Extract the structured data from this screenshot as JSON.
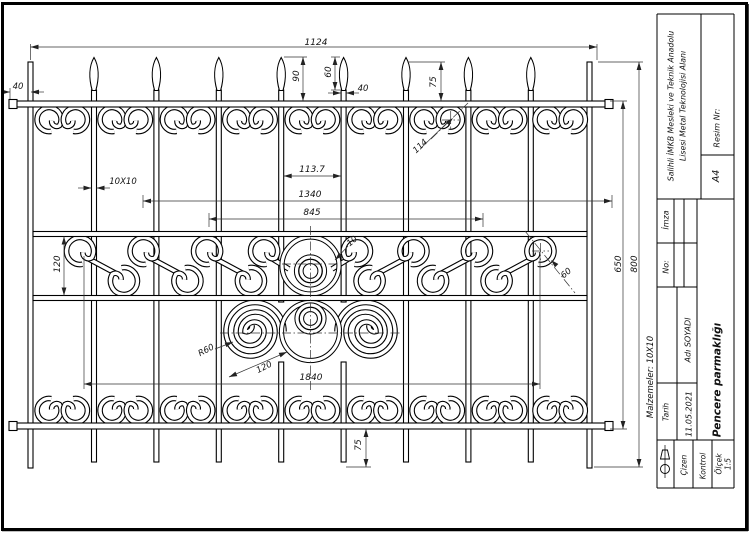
{
  "page": {
    "kind": "technical-drawing",
    "paper": "A4",
    "orientation": "landscape"
  },
  "title_block": {
    "school_line1": "Salihli İMKB Mesleki ve Teknik Anadolu",
    "school_line2": "Lisesi Metal Teknolojisi Alanı",
    "resim_label": "Resim Nr:",
    "paper_size": "A4",
    "imza_label": "İmza",
    "no_label": "No:",
    "author": "Adı SOYADI",
    "tarih_label": "Tarih",
    "tarih_value": "11.05.2021",
    "cizen_label": "Çizen",
    "kontrol_label": "Kontrol",
    "olcek_label": "Ölçek",
    "olcek_value": "1:5",
    "drawing_title": "Pencere parmaklığı",
    "materials_note": "Malzemeler: 10X10"
  },
  "tb_labels": [
    {
      "id": "school-1",
      "t": "Salihli İMKB Mesleki ve Teknik Anadolu",
      "x": 671,
      "y": 106,
      "rot": -90,
      "s": 7.8
    },
    {
      "id": "school-2",
      "t": "Lisesi Metal Teknolojisi Alanı",
      "x": 683,
      "y": 106,
      "rot": -90,
      "s": 7.8
    },
    {
      "id": "resim-nr",
      "t": "Resim Nr:",
      "x": 717,
      "y": 128,
      "rot": -90,
      "s": 8
    },
    {
      "id": "paper",
      "t": "A4",
      "x": 716,
      "y": 176,
      "rot": -90,
      "s": 9.5
    },
    {
      "id": "imza",
      "t": "İmza",
      "x": 666,
      "y": 220,
      "rot": -90,
      "s": 8
    },
    {
      "id": "no",
      "t": "No:",
      "x": 666,
      "y": 267,
      "rot": -90,
      "s": 8
    },
    {
      "id": "author",
      "t": "Adı SOYADI",
      "x": 688,
      "y": 340,
      "rot": -90,
      "s": 8
    },
    {
      "id": "tarih",
      "t": "Tarih",
      "x": 666,
      "y": 412,
      "rot": -90,
      "s": 7.5
    },
    {
      "id": "tarih-val",
      "t": "11.05.2021",
      "x": 689,
      "y": 414,
      "rot": -90,
      "s": 8
    },
    {
      "id": "cizen",
      "t": "Çizen",
      "x": 684,
      "y": 465,
      "rot": -90,
      "s": 7.5
    },
    {
      "id": "kontrol",
      "t": "Kontrol",
      "x": 703,
      "y": 466,
      "rot": -90,
      "s": 7.5
    },
    {
      "id": "olcek",
      "t": "Ölçek",
      "x": 719,
      "y": 464,
      "rot": -90,
      "s": 7.5
    },
    {
      "id": "olcek-val",
      "t": "1:5",
      "x": 728,
      "y": 464,
      "rot": -90,
      "s": 7.5
    },
    {
      "id": "drawing-title",
      "t": "Pencere parmaklığı",
      "x": 717,
      "y": 380,
      "rot": -90,
      "s": 10.5,
      "b": 1
    },
    {
      "id": "materials",
      "t": "Malzemeler: 10X10",
      "x": 650,
      "y": 377,
      "rot": -90,
      "s": 8.5
    }
  ],
  "dimensions": [
    {
      "t": "1124",
      "x": 316,
      "y": 42,
      "rot": 0,
      "lines": [
        [
          30.5,
          47,
          597,
          47
        ],
        [
          30.5,
          44,
          30.5,
          60
        ],
        [
          597,
          44,
          597,
          60
        ]
      ],
      "arr": [
        [
          30.5,
          47,
          180
        ],
        [
          597,
          47,
          0
        ]
      ]
    },
    {
      "t": "40",
      "x": 18,
      "y": 86,
      "rot": 0,
      "s": 8.5,
      "lines": [
        [
          2,
          92,
          10,
          92
        ],
        [
          31,
          92,
          44,
          92
        ],
        [
          10,
          88,
          10,
          99
        ]
      ],
      "arr": [
        [
          10,
          92,
          0
        ],
        [
          31,
          92,
          180
        ]
      ]
    },
    {
      "t": "90",
      "x": 296,
      "y": 76,
      "rot": -90,
      "lines": [
        [
          303,
          57,
          303,
          101
        ],
        [
          284,
          57,
          307,
          57
        ]
      ],
      "arr": [
        [
          303,
          57,
          -90
        ],
        [
          303,
          101,
          90
        ]
      ]
    },
    {
      "t": "60",
      "x": 328,
      "y": 72,
      "rot": -90,
      "lines": [
        [
          335,
          57,
          335,
          90
        ],
        [
          340,
          57,
          331,
          57
        ],
        [
          340,
          90,
          331,
          90
        ]
      ],
      "arr": [
        [
          335,
          57,
          -90
        ],
        [
          335,
          90,
          90
        ]
      ]
    },
    {
      "t": "40",
      "x": 363,
      "y": 88,
      "rot": 0,
      "s": 8.5,
      "lines": [
        [
          328,
          93,
          341,
          93
        ],
        [
          346,
          93,
          359,
          93
        ]
      ],
      "arr": [
        [
          341,
          93,
          0
        ],
        [
          346,
          93,
          180
        ]
      ]
    },
    {
      "t": "75",
      "x": 433,
      "y": 82,
      "rot": -90,
      "lines": [
        [
          441,
          62,
          441,
          101
        ],
        [
          408,
          62,
          445,
          62
        ]
      ],
      "arr": [
        [
          441,
          62,
          -90
        ],
        [
          441,
          101,
          90
        ]
      ]
    },
    {
      "t": "114",
      "x": 420,
      "y": 146,
      "rot": -43,
      "s": 8.5,
      "lines": [
        [
          421,
          148,
          449,
          121
        ]
      ],
      "dd": [
        [
          431,
          139,
          468,
          103
        ],
        [
          442,
          120,
          459,
          120
        ],
        [
          450.7,
          111,
          450.7,
          129
        ]
      ],
      "arr": [
        [
          453,
          118,
          -44
        ]
      ]
    },
    {
      "t": "10X10",
      "x": 123,
      "y": 181,
      "rot": 0,
      "s": 8.5,
      "lines": [
        [
          78,
          188,
          91.5,
          188
        ],
        [
          96.5,
          188,
          110,
          188
        ]
      ],
      "arr": [
        [
          91.5,
          188,
          0
        ],
        [
          96.5,
          188,
          180
        ]
      ]
    },
    {
      "t": "113.7",
      "x": 312,
      "y": 169,
      "rot": 0,
      "lines": [
        [
          283.7,
          176,
          341.1,
          176
        ]
      ],
      "arr": [
        [
          283.7,
          176,
          180
        ],
        [
          341.1,
          176,
          0
        ]
      ]
    },
    {
      "t": "1340",
      "x": 310,
      "y": 194,
      "rot": 0,
      "lines": [
        [
          143,
          201,
          612,
          201
        ],
        [
          143,
          195,
          143,
          208
        ],
        [
          612,
          195,
          612,
          208
        ]
      ],
      "arr": [
        [
          143,
          201,
          180
        ],
        [
          612,
          201,
          0
        ]
      ]
    },
    {
      "t": "845",
      "x": 312,
      "y": 212,
      "rot": 0,
      "lines": [
        [
          209,
          219,
          483,
          219
        ],
        [
          209,
          213,
          209,
          227
        ],
        [
          483,
          213,
          483,
          227
        ]
      ],
      "arr": [
        [
          209,
          219,
          180
        ],
        [
          483,
          219,
          0
        ]
      ]
    },
    {
      "t": "120",
      "x": 57,
      "y": 264,
      "rot": -90,
      "lines": [
        [
          64,
          236.5,
          64,
          295.5
        ]
      ],
      "arr": [
        [
          64,
          236.5,
          -90
        ],
        [
          64,
          295.5,
          90
        ]
      ]
    },
    {
      "t": "10",
      "x": 352,
      "y": 241,
      "rot": -40,
      "s": 8.5,
      "lines": [
        [
          348,
          246,
          335,
          260
        ]
      ],
      "arr": [
        [
          335,
          260,
          135
        ]
      ]
    },
    {
      "t": "60",
      "x": 566,
      "y": 273,
      "rot": -40,
      "s": 8.5,
      "lines": [],
      "dd": [
        [
          525,
          231,
          575,
          293
        ],
        [
          532,
          251,
          549,
          251
        ],
        [
          540.5,
          243,
          540.5,
          260
        ]
      ],
      "arr": [
        [
          551,
          260,
          -135
        ]
      ]
    },
    {
      "t": "650",
      "x": 618,
      "y": 264,
      "rot": -90,
      "lines": [
        [
          623,
          101,
          623,
          429
        ],
        [
          610,
          101,
          627,
          101
        ],
        [
          610,
          429,
          627,
          429
        ]
      ],
      "arr": [
        [
          623,
          101,
          -90
        ],
        [
          623,
          429,
          90
        ]
      ]
    },
    {
      "t": "800",
      "x": 634,
      "y": 264,
      "rot": -90,
      "lines": [
        [
          639,
          62,
          639,
          467
        ],
        [
          598,
          62,
          643,
          62
        ],
        [
          594,
          467,
          643,
          467
        ]
      ],
      "arr": [
        [
          639,
          62,
          -90
        ],
        [
          639,
          467,
          90
        ]
      ]
    },
    {
      "t": "R60",
      "x": 206,
      "y": 350,
      "rot": -28,
      "s": 8.5,
      "lines": [
        [
          215,
          349,
          233,
          342
        ]
      ],
      "arr": [
        [
          233,
          342,
          -21
        ]
      ]
    },
    {
      "t": "120",
      "x": 264,
      "y": 367,
      "rot": -27,
      "s": 8.5,
      "lines": [
        [
          229,
          377,
          287,
          352
        ]
      ],
      "arr": [
        [
          287,
          352,
          -23
        ],
        [
          229,
          377,
          157
        ]
      ]
    },
    {
      "t": "1840",
      "x": 311,
      "y": 377,
      "rot": 0,
      "lines": [
        [
          84,
          384,
          540,
          384
        ],
        [
          84,
          256,
          84,
          389
        ],
        [
          540,
          256,
          540,
          389
        ]
      ],
      "arr": [
        [
          84,
          384,
          180
        ],
        [
          540,
          384,
          0
        ]
      ]
    },
    {
      "t": "75",
      "x": 358,
      "y": 445,
      "rot": -90,
      "lines": [
        [
          366,
          429,
          366,
          467
        ],
        [
          346,
          467,
          371,
          467
        ]
      ],
      "arr": [
        [
          366,
          429,
          -90
        ],
        [
          366,
          467,
          90
        ]
      ]
    }
  ]
}
